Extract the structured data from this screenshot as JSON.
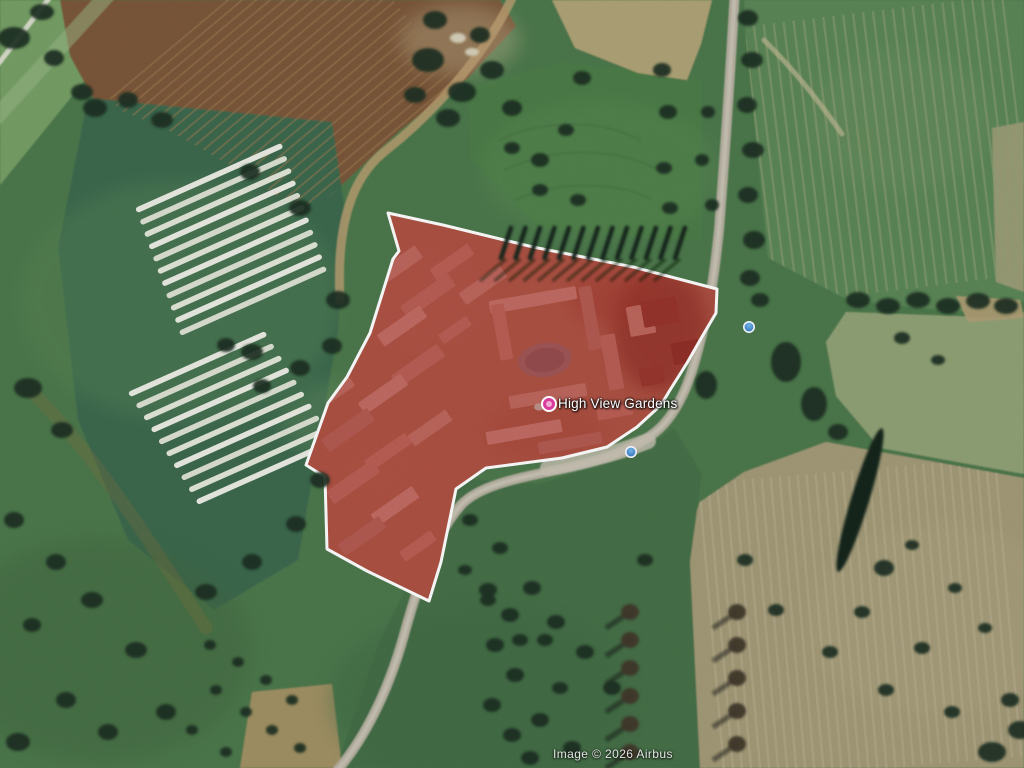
{
  "place_label": {
    "text": "High View Gardens",
    "x": 558,
    "y": 396
  },
  "attribution": {
    "text": "Image © 2026 Airbus",
    "x": 553,
    "y": 747
  },
  "colors": {
    "parcel_fill": "#b2201c",
    "parcel_stroke": "#ffffff",
    "pin": "#d93c9d",
    "pin_inner": "#f2a9d2",
    "photo_blue_top": "#74b4e8",
    "photo_blue_bottom": "#2d6cb2",
    "tree": "#1d3122",
    "road": "#b8b2a3"
  },
  "markers": {
    "place": {
      "x": 549,
      "y": 404
    },
    "photos": [
      {
        "x": 631,
        "y": 452
      },
      {
        "x": 749,
        "y": 327
      }
    ]
  },
  "parcel": {
    "points": "388,213 399,251 393,259 370,333 347,377 328,403 306,465 325,477 327,549 367,571 429,601 441,562 456,489 486,468 562,458 607,447 637,427 661,405 670,390 687,363 703,335 716,313 717,289 633,267 533,247 443,225",
    "fill_opacity": 0.52,
    "stroke_width": 3,
    "ground_fill": "#aa8a70"
  },
  "scene": {
    "base_color": "#4e794d",
    "fields": [
      {
        "name": "field-topleft-stripes",
        "points": "0,0 150,0 0,185",
        "fill": "#77a066",
        "op": 1
      },
      {
        "name": "field-brown-topleft",
        "points": "60,0 500,0 516,26 468,78 398,132 330,196 298,212 250,176 160,126 94,100 70,56",
        "fill": "#7b583a",
        "op": 1
      },
      {
        "name": "field-greenhouse",
        "points": "88,98 332,122 346,218 338,332 298,560 214,610 128,540 78,420 58,248",
        "fill": "#3e6a50",
        "op": 1
      },
      {
        "name": "field-meadow",
        "points": "468,88 560,62 640,70 702,80 702,240 640,238 540,228 470,160",
        "fill": "#4e7d4a",
        "op": 1
      },
      {
        "name": "field-wheat",
        "points": "552,0 712,0 701,44 687,80 638,73 575,48",
        "fill": "#b0a478",
        "op": 1
      },
      {
        "name": "field-topright-green",
        "points": "744,0 1024,0 1024,302 958,312 848,300 768,258 754,118 746,40",
        "fill": "#5b8758",
        "op": 1
      },
      {
        "name": "field-right-pale-strip",
        "points": "992,128 1024,122 1024,292 996,282",
        "fill": "#a6a17c",
        "op": 0.85
      },
      {
        "name": "field-right-palegreen",
        "points": "846,312 1008,318 1024,312 1024,474 880,448 836,396 826,342",
        "fill": "#92a377",
        "op": 1
      },
      {
        "name": "field-khaki-bottomright",
        "points": "700,502 744,472 826,442 880,452 1024,478 1024,768 698,768 678,562",
        "fill": "#a49b79",
        "op": 1
      },
      {
        "name": "field-olive-rough",
        "points": "452,478 540,484 640,452 674,428 702,474 690,562 700,768 336,768 380,640 420,560 444,512",
        "fill": "#477149",
        "op": 1
      },
      {
        "name": "field-tan-corner",
        "points": "956,296 1020,300 1024,318 968,322",
        "fill": "#b3a077",
        "op": 0.9
      },
      {
        "name": "dirt-patch-bottom",
        "points": "252,692 332,684 342,768 240,768",
        "fill": "#b1976a",
        "op": 0.85
      }
    ],
    "washes": [
      [
        180,
        300,
        160,
        120,
        "#5d8a58",
        0.35
      ],
      [
        100,
        650,
        150,
        110,
        "#42663f",
        0.4
      ],
      [
        600,
        170,
        120,
        70,
        "#5d8f57",
        0.35
      ],
      [
        480,
        700,
        150,
        90,
        "#3f6a44",
        0.4
      ],
      [
        940,
        620,
        130,
        95,
        "#b0a783",
        0.3
      ],
      [
        340,
        420,
        60,
        40,
        "#6f9a64",
        0.3
      ],
      [
        460,
        40,
        60,
        35,
        "#c9bd96",
        0.35
      ],
      [
        900,
        120,
        90,
        70,
        "#6f9465",
        0.3
      ]
    ],
    "streak_sets": [
      {
        "name": "plow-brown-topleft",
        "clip": "60,0 500,0 516,26 468,78 398,132 330,196 298,212 250,176 160,126 94,100 70,56",
        "cx": 290,
        "cy": 95,
        "angle": -40,
        "length": 280,
        "count": 26,
        "spacing": 9,
        "color": "#9d7c52",
        "width": 2,
        "op": 0.5
      },
      {
        "name": "streaks-topright",
        "clip": "744,0 1024,0 1024,302 958,312 848,300 768,258 754,118 746,40",
        "cx": 890,
        "cy": 150,
        "angle": 83,
        "length": 280,
        "count": 27,
        "spacing": 10,
        "color": "#93a277",
        "width": 2.5,
        "op": 0.5
      },
      {
        "name": "streaks-khaki",
        "clip": "700,502 744,472 826,442 880,452 1024,478 1024,768 698,768 678,562",
        "cx": 860,
        "cy": 620,
        "angle": 85,
        "length": 300,
        "count": 34,
        "spacing": 9,
        "color": "#b9b091",
        "width": 2.5,
        "op": 0.5
      }
    ],
    "paths": [
      {
        "name": "band-topleft-light",
        "d": "M -12,126 L 132,-32",
        "stroke": "#9dbb8a",
        "w": 16,
        "op": 0.5
      },
      {
        "name": "road-topleft",
        "d": "M -8,72 L 54,-8",
        "stroke": "#dfe0d2",
        "w": 5,
        "op": 0.95
      },
      {
        "name": "track-tan-greenhouse",
        "d": "M 514,-6 C 488,50 440,108 384,152 C 352,178 336,224 340,300",
        "stroke": "#c0a374",
        "w": 9,
        "op": 0.8
      },
      {
        "name": "track-topright",
        "d": "M 764,40 C 796,72 818,100 842,134",
        "stroke": "#c2bb96",
        "w": 5,
        "op": 0.7
      },
      {
        "name": "track-dirt-left",
        "d": "M 36,396 C 92,452 152,544 206,628",
        "stroke": "#83703f",
        "w": 13,
        "op": 0.3
      },
      {
        "name": "road-main",
        "d": "M 735,-10 C 731,60 726,140 719,230 C 715,268 712,292 703,330 C 694,368 685,400 664,424 C 642,448 602,461 552,471 C 512,479 478,487 461,505 C 438,531 421,573 404,635 C 387,696 362,742 336,772",
        "stroke": "#b8b2a3",
        "w": 10,
        "op": 1
      },
      {
        "name": "road-main-core",
        "d": "M 735,-10 C 731,60 726,140 719,230 C 715,268 712,292 703,330 C 694,368 685,400 664,424 C 642,448 602,461 552,471 C 512,479 478,487 461,505 C 438,531 421,573 404,635 C 387,696 362,742 336,772",
        "stroke": "#ccc7b8",
        "w": 4,
        "op": 0.8
      },
      {
        "name": "road-entrance",
        "d": "M 648,441 C 610,456 575,463 548,468",
        "stroke": "#c9c3b4",
        "w": 16,
        "op": 0.8
      },
      {
        "name": "mow-swirl-1",
        "d": "M 500,140 C 540,120 600,118 640,140",
        "stroke": "#466f41",
        "w": 2,
        "op": 0.5
      },
      {
        "name": "mow-swirl-2",
        "d": "M 505,170 C 550,148 610,146 655,168",
        "stroke": "#466f41",
        "w": 2,
        "op": 0.5
      },
      {
        "name": "mow-swirl-3",
        "d": "M 515,200 C 555,182 610,180 650,198",
        "stroke": "#466f41",
        "w": 2,
        "op": 0.5
      }
    ],
    "greenhouse_groups": [
      {
        "name": "polytunnels-upper",
        "x": 135,
        "y": 208,
        "angle": -24,
        "rows": 11,
        "length": 160,
        "gap": 13,
        "stagger": -1,
        "h": 5.6
      },
      {
        "name": "polytunnels-lower",
        "x": 128,
        "y": 392,
        "angle": -24,
        "rows": 10,
        "length": 150,
        "gap": 14,
        "stagger": 2,
        "h": 5.6
      }
    ],
    "strip_fills": [
      "#eceee5",
      "#dde2d4",
      "#e4e8db"
    ],
    "site_washes": [
      [
        660,
        330,
        48,
        62,
        "#5e2e26",
        0.55
      ],
      [
        610,
        298,
        42,
        26,
        "#8a4a3a",
        0.4
      ],
      [
        420,
        300,
        70,
        50,
        "#b5907a",
        0.3
      ],
      [
        380,
        470,
        60,
        45,
        "#b08a6d",
        0.35
      ],
      [
        545,
        430,
        60,
        30,
        "#9b6a52",
        0.3
      ]
    ],
    "buildings": [
      [
        395,
        268,
        58,
        15,
        -35
      ],
      [
        428,
        296,
        58,
        15,
        -35
      ],
      [
        402,
        326,
        52,
        14,
        -35
      ],
      [
        366,
        302,
        36,
        12,
        -35
      ],
      [
        452,
        262,
        46,
        13,
        -35
      ],
      [
        483,
        285,
        50,
        14,
        -35
      ],
      [
        418,
        366,
        56,
        15,
        -35
      ],
      [
        383,
        394,
        52,
        14,
        -35
      ],
      [
        348,
        430,
        56,
        15,
        -35
      ],
      [
        388,
        452,
        50,
        13,
        -35
      ],
      [
        430,
        428,
        46,
        13,
        -35
      ],
      [
        353,
        482,
        56,
        15,
        -35
      ],
      [
        395,
        506,
        50,
        14,
        -35
      ],
      [
        362,
        536,
        50,
        14,
        -35
      ],
      [
        418,
        546,
        38,
        12,
        -35
      ],
      [
        340,
        390,
        30,
        10,
        -35
      ],
      [
        455,
        330,
        34,
        11,
        -35
      ],
      [
        533,
        300,
        88,
        13,
        -10
      ],
      [
        590,
        318,
        13,
        64,
        -10
      ],
      [
        502,
        332,
        13,
        56,
        -10
      ],
      [
        548,
        396,
        78,
        13,
        -10
      ],
      [
        612,
        362,
        15,
        56,
        -10
      ],
      [
        524,
        432,
        76,
        13,
        -10
      ],
      [
        570,
        443,
        64,
        12,
        -10
      ],
      [
        615,
        412,
        36,
        11,
        -10
      ],
      [
        641,
        320,
        26,
        30,
        -10
      ],
      [
        660,
        312,
        36,
        26,
        -10,
        "#7c4a3f"
      ],
      [
        686,
        352,
        28,
        22,
        -10,
        "#6f4238"
      ],
      [
        652,
        376,
        24,
        18,
        -10,
        "#7d5044"
      ]
    ],
    "building_palette": [
      "#cbb3a5",
      "#c0a494",
      "#d4bfb1",
      "#b79c8c",
      "#c7a392"
    ],
    "pond": {
      "cx": 545,
      "cy": 360,
      "rx": 27,
      "ry": 17,
      "angle": -8,
      "fill": "#8e9096",
      "inner": "#7a7d86"
    },
    "cypress_row": {
      "x0": 506,
      "y": 243,
      "count": 13,
      "dx": 14.5,
      "w": 4.5,
      "h": 36,
      "lean": 18,
      "color": "#18271c"
    },
    "diag_hedge": {
      "cx": 860,
      "cy": 500,
      "rx": 9,
      "ry": 75,
      "angle": 17,
      "fill": "#15261b"
    },
    "hedgerows": [
      {
        "x": 630,
        "y0": 612,
        "y1": 756,
        "step": 28,
        "color": "#41392a"
      },
      {
        "x": 737,
        "y0": 612,
        "y1": 746,
        "step": 33,
        "color": "#41392a"
      }
    ],
    "pale_spots": [
      [
        458,
        38,
        8,
        5
      ],
      [
        472,
        52,
        7,
        4
      ]
    ],
    "trees": [
      [
        14,
        38,
        16,
        11
      ],
      [
        42,
        12,
        12,
        8
      ],
      [
        54,
        58,
        10,
        8
      ],
      [
        82,
        92,
        11,
        8
      ],
      [
        95,
        108,
        12,
        9
      ],
      [
        128,
        100,
        10,
        8
      ],
      [
        162,
        120,
        11,
        8
      ],
      [
        250,
        172,
        10,
        8
      ],
      [
        300,
        208,
        11,
        8
      ],
      [
        338,
        300,
        12,
        9
      ],
      [
        332,
        346,
        10,
        8
      ],
      [
        300,
        368,
        10,
        8
      ],
      [
        252,
        352,
        11,
        8
      ],
      [
        226,
        345,
        9,
        7
      ],
      [
        262,
        386,
        9,
        7
      ],
      [
        320,
        480,
        10,
        8
      ],
      [
        296,
        524,
        10,
        8
      ],
      [
        252,
        562,
        10,
        8
      ],
      [
        206,
        592,
        11,
        8
      ],
      [
        28,
        388,
        14,
        10
      ],
      [
        62,
        430,
        11,
        8
      ],
      [
        14,
        520,
        10,
        8
      ],
      [
        56,
        562,
        10,
        8
      ],
      [
        92,
        600,
        11,
        8
      ],
      [
        32,
        625,
        9,
        7
      ],
      [
        136,
        650,
        11,
        8
      ],
      [
        66,
        700,
        10,
        8
      ],
      [
        18,
        742,
        12,
        9
      ],
      [
        108,
        732,
        10,
        8
      ],
      [
        166,
        712,
        10,
        8
      ],
      [
        210,
        645,
        6,
        5
      ],
      [
        238,
        662,
        6,
        5
      ],
      [
        266,
        680,
        6,
        5
      ],
      [
        292,
        700,
        6,
        5
      ],
      [
        216,
        690,
        6,
        5
      ],
      [
        246,
        712,
        6,
        5
      ],
      [
        272,
        730,
        6,
        5
      ],
      [
        300,
        748,
        6,
        5
      ],
      [
        192,
        730,
        6,
        5
      ],
      [
        226,
        752,
        6,
        5
      ],
      [
        428,
        60,
        16,
        12
      ],
      [
        462,
        92,
        14,
        10
      ],
      [
        492,
        70,
        12,
        9
      ],
      [
        448,
        118,
        12,
        9
      ],
      [
        415,
        95,
        11,
        8
      ],
      [
        480,
        35,
        10,
        8
      ],
      [
        435,
        20,
        12,
        9
      ],
      [
        512,
        108,
        10,
        8
      ],
      [
        540,
        160,
        9,
        7
      ],
      [
        566,
        130,
        8,
        6
      ],
      [
        582,
        78,
        9,
        7
      ],
      [
        512,
        148,
        8,
        6
      ],
      [
        540,
        190,
        8,
        6
      ],
      [
        578,
        200,
        8,
        6
      ],
      [
        662,
        70,
        9,
        7
      ],
      [
        668,
        112,
        9,
        7
      ],
      [
        664,
        168,
        8,
        6
      ],
      [
        670,
        208,
        8,
        6
      ],
      [
        706,
        385,
        11,
        14
      ],
      [
        786,
        362,
        15,
        20
      ],
      [
        814,
        404,
        13,
        17
      ],
      [
        760,
        300,
        9,
        7
      ],
      [
        748,
        18,
        10,
        8
      ],
      [
        752,
        60,
        11,
        8
      ],
      [
        747,
        105,
        10,
        8
      ],
      [
        753,
        150,
        11,
        8
      ],
      [
        748,
        195,
        10,
        8
      ],
      [
        754,
        240,
        11,
        9
      ],
      [
        750,
        278,
        10,
        8
      ],
      [
        708,
        112,
        7,
        6
      ],
      [
        702,
        160,
        7,
        6
      ],
      [
        712,
        205,
        7,
        6
      ],
      [
        858,
        300,
        12,
        8
      ],
      [
        888,
        306,
        12,
        8
      ],
      [
        918,
        300,
        12,
        8
      ],
      [
        948,
        306,
        12,
        8
      ],
      [
        978,
        301,
        12,
        8
      ],
      [
        1006,
        306,
        12,
        8
      ],
      [
        902,
        338,
        8,
        6
      ],
      [
        938,
        360,
        7,
        5
      ],
      [
        838,
        432,
        10,
        8
      ],
      [
        884,
        568,
        10,
        8
      ],
      [
        912,
        545,
        7,
        5
      ],
      [
        955,
        588,
        7,
        5
      ],
      [
        862,
        612,
        8,
        6
      ],
      [
        922,
        648,
        8,
        6
      ],
      [
        985,
        628,
        7,
        5
      ],
      [
        1010,
        700,
        9,
        7
      ],
      [
        952,
        712,
        8,
        6
      ],
      [
        886,
        690,
        8,
        6
      ],
      [
        830,
        652,
        8,
        6
      ],
      [
        776,
        610,
        8,
        6
      ],
      [
        745,
        560,
        8,
        6
      ],
      [
        992,
        752,
        14,
        10
      ],
      [
        1020,
        730,
        12,
        9
      ],
      [
        470,
        520,
        8,
        6
      ],
      [
        500,
        548,
        8,
        6
      ],
      [
        532,
        588,
        9,
        7
      ],
      [
        556,
        622,
        9,
        7
      ],
      [
        585,
        652,
        9,
        7
      ],
      [
        612,
        688,
        9,
        7
      ],
      [
        560,
        688,
        8,
        6
      ],
      [
        520,
        640,
        8,
        6
      ],
      [
        488,
        600,
        8,
        6
      ],
      [
        465,
        570,
        7,
        5
      ],
      [
        540,
        720,
        9,
        7
      ],
      [
        572,
        748,
        9,
        7
      ],
      [
        645,
        560,
        8,
        6
      ],
      [
        488,
        590,
        9,
        7
      ],
      [
        510,
        615,
        9,
        7
      ],
      [
        495,
        645,
        9,
        7
      ],
      [
        515,
        675,
        9,
        7
      ],
      [
        492,
        705,
        9,
        7
      ],
      [
        512,
        735,
        9,
        7
      ],
      [
        530,
        758,
        9,
        7
      ],
      [
        545,
        640,
        8,
        6
      ]
    ]
  }
}
